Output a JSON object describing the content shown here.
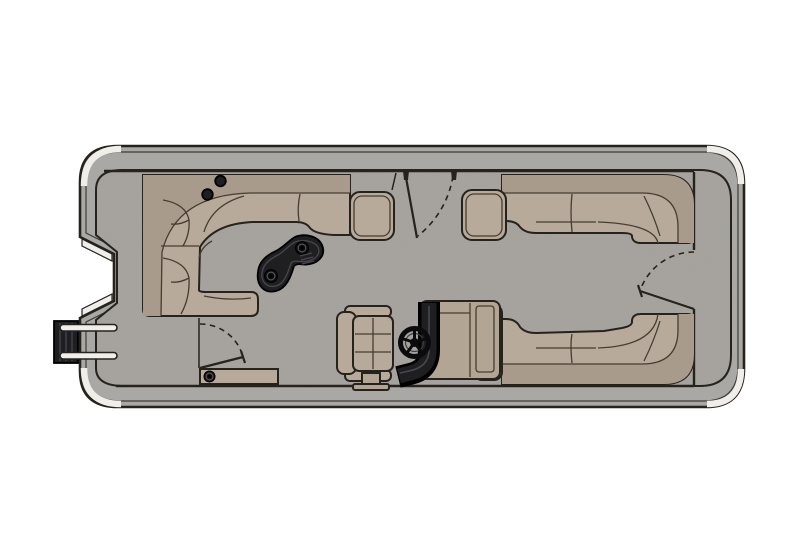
{
  "meta": {
    "title": "Pontoon Boat Floor Plan",
    "view": "top-down",
    "description": "Top-down floor plan illustration of a pontoon boat with wraparound lounge seating, bow cocktail table, helm station with captain's chair, three swing gates, stern deck and a port boarding ladder"
  },
  "colors": {
    "page_bg": "#ffffff",
    "hull_band": "#a9a8a5",
    "outline": "#26221c",
    "carpet": "#a7a49f",
    "seat": "#b7aa9b",
    "seat_shadow": "#a89b8c",
    "seam": "#453d31",
    "dark_part": "#1f1f22",
    "dark_mid": "#47474d",
    "trim_light": "#efeeeb",
    "console": "#b2a593"
  },
  "components": {
    "hull": "Hull and rub rail",
    "stern_deck": "Stern deck platform",
    "carpet": "Carpeted main deck",
    "ladder": "Bow boarding ladder",
    "bow_lounge": "Bow L-shaped lounge",
    "bow_armrest": "Bow lounge armrest",
    "cupholders": "Corner cup holders",
    "bow_table": "Kidney cocktail table",
    "side_gate": "Side entry gate (open)",
    "stern_gate": "Stern entry gate (open)",
    "bow_gate": "Port bow gate (open)",
    "boarding_step": "Boarding step with cup holder",
    "starboard_lounge": "Starboard stern L-lounge",
    "starboard_armrest": "Starboard lounge armrest",
    "port_lounge": "Port stern L-lounge",
    "port_end_piece": "Port lounge end console",
    "helm": "Helm console",
    "windscreen": "Helm windscreen panel",
    "steering_wheel": "Steering wheel",
    "captains_chair": "Captain's chair",
    "chair_pedestal": "Chair pedestal"
  }
}
